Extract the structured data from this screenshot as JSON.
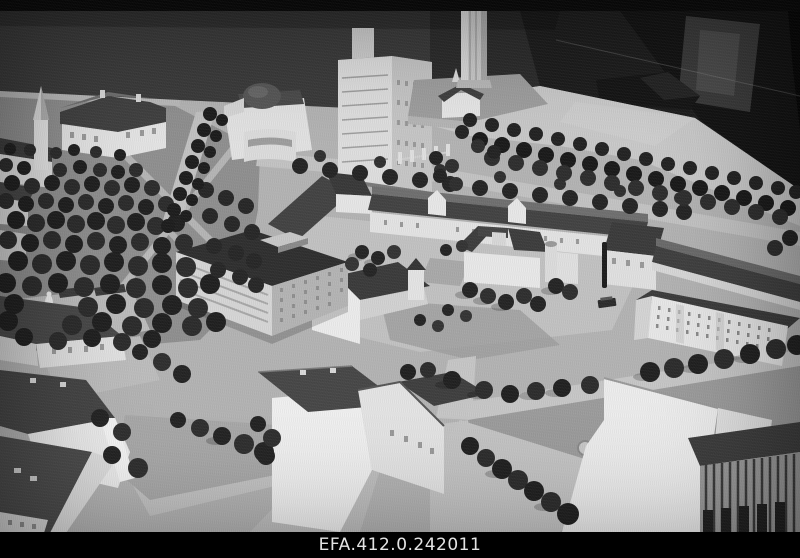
{
  "photo": {
    "watermark": "EFA.412.0.242011",
    "description": "Black-and-white archival photograph of an architectural scale model of a city centre: white model buildings with dark roofs, tree-lined streets, a park with a statue, a tall tower on a bastion, shown against a dark exhibition background with a black caption bar at the bottom.",
    "colors": {
      "background": "#0a0a0a",
      "back_wall": "#3a3a3a",
      "model_surface": "#b3b3b3",
      "model_rim": "#c9c9c9",
      "road": "#c6c6c6",
      "grass": "#9c9c9c",
      "building_wall": "#e8e8e8",
      "roof": "#424242",
      "tree": "#262626",
      "watermark_bar": "#000000",
      "watermark_text": "#e4e4e4"
    }
  }
}
